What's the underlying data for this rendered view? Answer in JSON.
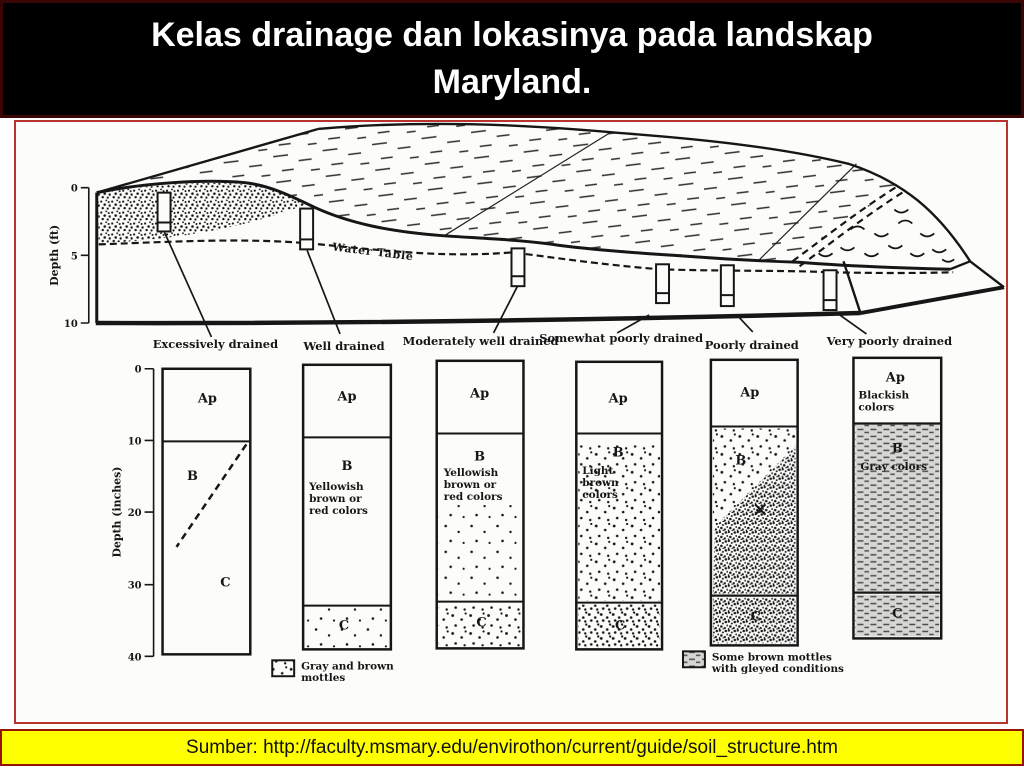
{
  "title_lines": [
    "Kelas drainage dan lokasinya pada landskap",
    "Maryland."
  ],
  "footer": {
    "source": "Sumber: http://faculty.msmary.edu/envirothon/current/guide/soil_structure.htm"
  },
  "block_diagram": {
    "depth_ft_axis": {
      "label": "Depth (ft)",
      "ticks": [
        "0",
        "5",
        "10"
      ]
    },
    "water_table_label": "Water Table"
  },
  "profile_section": {
    "depth_in_axis": {
      "label": "Depth (inches)",
      "ticks": [
        "0",
        "10",
        "20",
        "30",
        "40"
      ]
    },
    "columns": [
      {
        "label": "Excessively drained",
        "ap": "Ap",
        "b": "B",
        "c": "C"
      },
      {
        "label": "Well drained",
        "ap": "Ap",
        "b": "B",
        "c": "C",
        "b_desc": [
          "Yellowish",
          "brown or",
          "red colors"
        ]
      },
      {
        "label": "Moderately well drained",
        "ap": "Ap",
        "b": "B",
        "c": "C",
        "b_desc": [
          "Yellowish",
          "brown or",
          "red colors"
        ]
      },
      {
        "label": "Somewhat poorly drained",
        "ap": "Ap",
        "b": "B",
        "c": "C",
        "b_desc": [
          "Light",
          "brown",
          "colors"
        ]
      },
      {
        "label": "Poorly drained",
        "ap": "Ap",
        "b": "B",
        "c": "C"
      },
      {
        "label": "Very poorly drained",
        "ap": "Ap",
        "b": "B",
        "c": "C",
        "ap_desc": [
          "Blackish",
          "colors"
        ],
        "b_desc": [
          "Gray colors"
        ]
      }
    ],
    "legends": [
      {
        "lines": [
          "Gray and brown",
          "mottles"
        ]
      },
      {
        "lines": [
          "Some brown mottles",
          "with gleyed conditions"
        ]
      }
    ]
  },
  "colors": {
    "header_bg": "#000000",
    "header_border": "#3a0505",
    "title_color": "#ffffff",
    "content_border": "#b5342e",
    "footer_bg": "#ffff00",
    "footer_border": "#941505",
    "ink": "#161616"
  }
}
